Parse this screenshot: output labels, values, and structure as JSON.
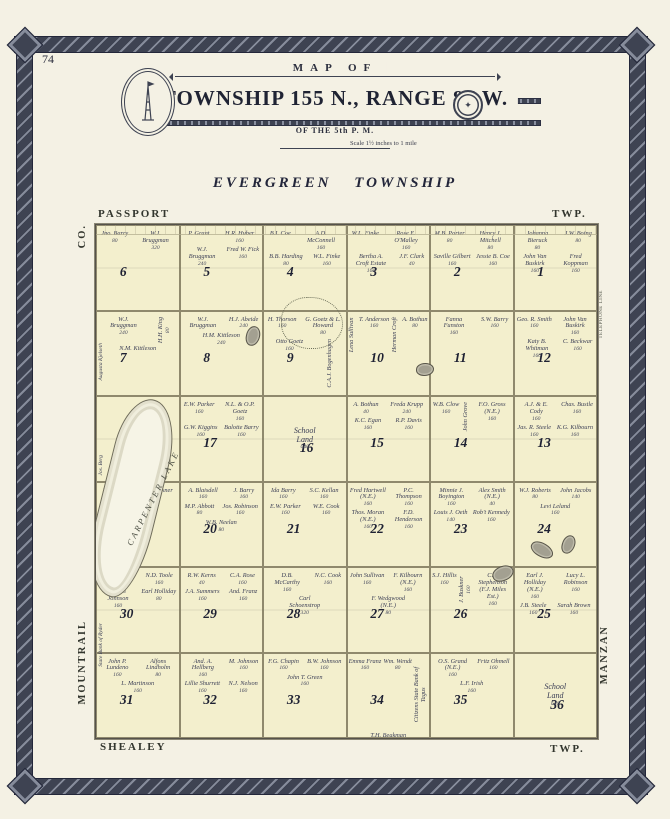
{
  "page": {
    "number": "74"
  },
  "banner": {
    "arc_text": "MAP OF",
    "title": "TOWNSHIP 155 N., RANGE 87 W.",
    "subtitle": "OF THE 5th P. M.",
    "scale_note": "Scale 1½ inches to 1 mile",
    "seal_glyph": "✦"
  },
  "heading": {
    "title": "EVERGREEN TOWNSHIP"
  },
  "border_labels": {
    "top_left": "PASSPORT",
    "top_right": "TWP.",
    "bottom_left": "SHEALEY",
    "bottom_right": "TWP.",
    "left_top": "CO.",
    "left_bottom": "MOUNTRAIL",
    "right_bottom": "MANZAN",
    "right_note": "TELEPHONE LINE"
  },
  "map": {
    "lake_label": "CARPENTER LAKE",
    "west_names": [
      "Jos. Berg",
      "Augusta Kjelseth",
      "State Bank of Ryder"
    ],
    "sections": [
      {
        "num": "6",
        "owners": [
          {
            "n": "Jno. Barry",
            "a": "80"
          },
          {
            "n": "W.J. Bruggman",
            "a": "320"
          }
        ]
      },
      {
        "num": "5",
        "owners": [
          {
            "n": "P. Grant",
            "a": ""
          },
          {
            "n": "H.R. Huber",
            "a": "160"
          },
          {
            "n": "W.J. Bruggman",
            "a": "240"
          },
          {
            "n": "Fred W. Fick",
            "a": "160"
          }
        ]
      },
      {
        "num": "4",
        "owners": [
          {
            "n": "B.I. Coe",
            "a": ""
          },
          {
            "n": "A.D. McConnell",
            "a": "160"
          },
          {
            "n": "B.B. Harding",
            "a": "80"
          },
          {
            "n": "W.L. Finke",
            "a": "160"
          }
        ]
      },
      {
        "num": "3",
        "owners": [
          {
            "n": "W.L. Finke",
            "a": ""
          },
          {
            "n": "Rose E. O'Malley",
            "a": "160"
          },
          {
            "n": "Bertha A. Croft Estate",
            "a": "160"
          },
          {
            "n": "J.F. Clark",
            "a": "40"
          }
        ]
      },
      {
        "num": "2",
        "owners": [
          {
            "n": "M.B. Porter",
            "a": "80"
          },
          {
            "n": "Henry J. Mitchell",
            "a": "80"
          },
          {
            "n": "Saville Gilbert",
            "a": "160"
          },
          {
            "n": "Jessie B. Coe",
            "a": "160"
          }
        ]
      },
      {
        "num": "1",
        "owners": [
          {
            "n": "Johanna Bieruck",
            "a": "80"
          },
          {
            "n": "J.W. Boing",
            "a": "80"
          },
          {
            "n": "John Van Buskirk",
            "a": "160"
          },
          {
            "n": "Fred Koppman",
            "a": "160"
          }
        ]
      },
      {
        "num": "7",
        "owners": [
          {
            "n": "W.J. Bruggman",
            "a": "240"
          },
          {
            "n": "H.H. King",
            "a": "80",
            "v": true
          },
          {
            "n": "N.M. Kittleson",
            "a": ""
          }
        ]
      },
      {
        "num": "8",
        "owners": [
          {
            "n": "W.J. Bruggman",
            "a": ""
          },
          {
            "n": "H.J. Abeide",
            "a": "240"
          },
          {
            "n": "H.M. Kittleson",
            "a": "240"
          }
        ]
      },
      {
        "num": "9",
        "owners": [
          {
            "n": "H. Thorson",
            "a": "160"
          },
          {
            "n": "G. Goetz & L. Howard",
            "a": "80"
          },
          {
            "n": "Otto Goetz",
            "a": "160"
          },
          {
            "n": "C.A.J. Bogenhagen",
            "a": "",
            "v": true
          }
        ]
      },
      {
        "num": "10",
        "owners": [
          {
            "n": "Lena Sullivan",
            "a": "",
            "v": true
          },
          {
            "n": "T. Anderson",
            "a": "160"
          },
          {
            "n": "Herman Croft",
            "a": "",
            "v": true
          },
          {
            "n": "A. Bothun",
            "a": "80"
          }
        ]
      },
      {
        "num": "11",
        "owners": [
          {
            "n": "Fanna Funston",
            "a": "160"
          },
          {
            "n": "S.W. Barry",
            "a": "160"
          }
        ]
      },
      {
        "num": "12",
        "owners": [
          {
            "n": "Geo. R. Smith",
            "a": "160"
          },
          {
            "n": "John Van Buskirk",
            "a": "160"
          },
          {
            "n": "Katy B. Whitman",
            "a": "160"
          },
          {
            "n": "C. Beckwar",
            "a": "160"
          }
        ]
      },
      {
        "num": "18",
        "owners": [
          {
            "n": "Edw. M. Kjos",
            "a": "80"
          }
        ]
      },
      {
        "num": "17",
        "owners": [
          {
            "n": "E.W. Parker",
            "a": "160"
          },
          {
            "n": "N.L. & O.P. Goetz",
            "a": "160"
          },
          {
            "n": "G.W. Kiggins",
            "a": "160"
          },
          {
            "n": "Balotte Barry",
            "a": "160"
          }
        ]
      },
      {
        "num": "16",
        "owners": [
          {
            "n": "School Land",
            "a": "640"
          }
        ]
      },
      {
        "num": "15",
        "owners": [
          {
            "n": "A. Bothun",
            "a": "40"
          },
          {
            "n": "Freda Krupp",
            "a": "240"
          },
          {
            "n": "K.C. Egan",
            "a": "160"
          },
          {
            "n": "R.P. Davis",
            "a": "160"
          }
        ]
      },
      {
        "num": "14",
        "owners": [
          {
            "n": "W.B. Clow",
            "a": "160"
          },
          {
            "n": "John Grove",
            "a": "",
            "v": true
          },
          {
            "n": "F.O. Gross (N.E.)",
            "a": "160"
          }
        ]
      },
      {
        "num": "13",
        "owners": [
          {
            "n": "A.J. & E. Cody",
            "a": "160"
          },
          {
            "n": "Chas. Bustle",
            "a": "160"
          },
          {
            "n": "Jas. R. Steele",
            "a": "160"
          },
          {
            "n": "K.G. Kilbourn",
            "a": "160"
          }
        ]
      },
      {
        "num": "19",
        "owners": [
          {
            "n": "Ida Barry",
            "a": "80"
          },
          {
            "n": "Anta Buskner",
            "a": "160"
          }
        ]
      },
      {
        "num": "20",
        "owners": [
          {
            "n": "A. Blaisdell",
            "a": "160"
          },
          {
            "n": "J. Barry",
            "a": "160"
          },
          {
            "n": "M.P. Abbott",
            "a": "80"
          },
          {
            "n": "Jos. Robinson",
            "a": "160"
          },
          {
            "n": "W.B. Neelan",
            "a": "80"
          }
        ]
      },
      {
        "num": "21",
        "owners": [
          {
            "n": "Ida Barry",
            "a": "160"
          },
          {
            "n": "S.C. Kellan",
            "a": "160"
          },
          {
            "n": "E.W. Parker",
            "a": "160"
          },
          {
            "n": "W.E. Cook",
            "a": "160"
          }
        ]
      },
      {
        "num": "22",
        "owners": [
          {
            "n": "Fred Hartwell (N.E.)",
            "a": "160"
          },
          {
            "n": "P.C. Thompson",
            "a": "160"
          },
          {
            "n": "Thos. Moran (N.E.)",
            "a": "160"
          },
          {
            "n": "F.D. Henderson",
            "a": "160"
          }
        ]
      },
      {
        "num": "23",
        "owners": [
          {
            "n": "Minnie J. Boyington",
            "a": "160"
          },
          {
            "n": "Alex Smith (N.E.)",
            "a": "40"
          },
          {
            "n": "Louis J. Oeth",
            "a": "140"
          },
          {
            "n": "Rob't Kennedy",
            "a": "160"
          }
        ]
      },
      {
        "num": "24",
        "owners": [
          {
            "n": "W.J. Roberts",
            "a": "80"
          },
          {
            "n": "John Jacobs",
            "a": "140"
          },
          {
            "n": "Levi Leland",
            "a": "160"
          }
        ]
      },
      {
        "num": "30",
        "owners": [
          {
            "n": "Fred Brandt",
            "a": "80"
          },
          {
            "n": "N.D. Toole",
            "a": "160"
          },
          {
            "n": "Karen Johnson",
            "a": "160"
          },
          {
            "n": "Earl Holliday",
            "a": "80"
          }
        ]
      },
      {
        "num": "29",
        "owners": [
          {
            "n": "R.W. Kerns",
            "a": "40"
          },
          {
            "n": "C.A. Rose",
            "a": "160"
          },
          {
            "n": "J.A. Summers",
            "a": "160"
          },
          {
            "n": "And. Franz",
            "a": "160"
          }
        ]
      },
      {
        "num": "28",
        "owners": [
          {
            "n": "D.B. McCarthy",
            "a": "160"
          },
          {
            "n": "N.C. Cook",
            "a": "160"
          },
          {
            "n": "Carl Schoenstrop",
            "a": "320"
          }
        ]
      },
      {
        "num": "27",
        "owners": [
          {
            "n": "John Sullivan",
            "a": "160"
          },
          {
            "n": "F. Kilbourn (N.E.)",
            "a": "160"
          },
          {
            "n": "F. Wedgwood (N.E.)",
            "a": "80"
          }
        ]
      },
      {
        "num": "26",
        "owners": [
          {
            "n": "S.J. Hillis",
            "a": "160"
          },
          {
            "n": "J. Buskner",
            "a": "160",
            "v": true
          },
          {
            "n": "C.L. Stephenson (F.J. Miles Est.)",
            "a": "160"
          }
        ]
      },
      {
        "num": "25",
        "owners": [
          {
            "n": "Earl J. Holliday (N.E.)",
            "a": "160"
          },
          {
            "n": "Lucy L. Robinson",
            "a": "160"
          },
          {
            "n": "J.B. Steele",
            "a": "160"
          },
          {
            "n": "Sarah Brown",
            "a": "160"
          }
        ]
      },
      {
        "num": "31",
        "owners": [
          {
            "n": "John P. Lundeno",
            "a": "160"
          },
          {
            "n": "Alfons Lindholm",
            "a": "80"
          },
          {
            "n": "L. Martinson",
            "a": "160"
          }
        ]
      },
      {
        "num": "32",
        "owners": [
          {
            "n": "And. A. Hellberg",
            "a": "160"
          },
          {
            "n": "M. Johnson",
            "a": "160"
          },
          {
            "n": "Lillie Shurrett",
            "a": "160"
          },
          {
            "n": "N.J. Nelson",
            "a": "160"
          }
        ]
      },
      {
        "num": "33",
        "owners": [
          {
            "n": "F.G. Chapin",
            "a": "160"
          },
          {
            "n": "B.W. Johnson",
            "a": "160"
          },
          {
            "n": "John T. Green",
            "a": "160"
          }
        ]
      },
      {
        "num": "34",
        "owners": [
          {
            "n": "Emma Franz",
            "a": "160"
          },
          {
            "n": "Wm. Wendt",
            "a": "80"
          },
          {
            "n": "Citizens State Bank of Tagus",
            "a": "",
            "v": true
          },
          {
            "n": "T.H. Beakman",
            "a": "160"
          }
        ]
      },
      {
        "num": "35",
        "owners": [
          {
            "n": "O.S. Grand (N.E.)",
            "a": "160"
          },
          {
            "n": "Fritz Ohmell",
            "a": "160"
          },
          {
            "n": "L.F. Irish",
            "a": "160"
          }
        ]
      },
      {
        "num": "36",
        "owners": [
          {
            "n": "School Land",
            "a": "640"
          }
        ]
      }
    ]
  }
}
